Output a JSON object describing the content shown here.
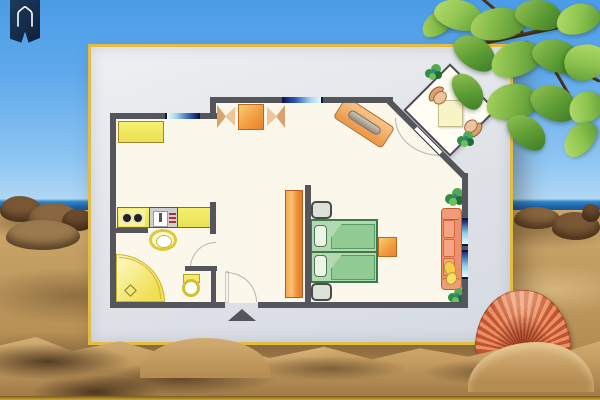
{
  "scene": {
    "type": "beach-themed apartment floor plan illustration",
    "background_elements": [
      "sky",
      "sea-horizon",
      "sandy-beach-dunes",
      "beach-rocks",
      "tree-branch-with-green-leaves",
      "scallop-seashell",
      "house-banner-badge"
    ],
    "badge": {
      "icon": "house-icon",
      "banner_color": "#16304f",
      "glyph_color": "#ffffff"
    },
    "palette": {
      "sky": "#58a8ea",
      "sea": "#1b5fa8",
      "sand": "#c49f64",
      "frame_border_gold": "#e2bd45",
      "mat_gray": "#e3e6ea",
      "wall_gray": "#55565c",
      "floor_cream": "#fbf7ea",
      "yellow_fixture": "#f2e968",
      "orange_furniture": "#f09a40",
      "sofa_coral": "#f0906a",
      "bed_green": "#aed8ae",
      "window_blue": "#122f7e",
      "plant_green": "#2f8f45",
      "shell_orange": "#d4653a",
      "leaf_green": "#6fae41"
    }
  },
  "floorplan": {
    "rooms": [
      {
        "name": "kitchen",
        "furniture": [
          "wall-cabinet",
          "kitchen-counter",
          "stove-two-burners",
          "kitchen-sink-unit",
          "wash-basin"
        ]
      },
      {
        "name": "bathroom",
        "furniture": [
          "corner-shower",
          "toilet",
          "door-swing"
        ]
      },
      {
        "name": "entry-hall",
        "furniture": [
          "entrance-door-swing",
          "entrance-triangle-marker",
          "wardrobe"
        ]
      },
      {
        "name": "living-bedroom",
        "furniture": [
          "double-bed",
          "nightstand-top",
          "nightstand-bottom",
          "side-table",
          "sofa-with-pillows",
          "dining-table",
          "dining-chair-left",
          "dining-chair-right",
          "angled-sideboard",
          "plant",
          "plant",
          "terrace-door-swing"
        ]
      },
      {
        "name": "diagonal-terrace",
        "furniture": [
          "terrace-table",
          "wicker-chair",
          "wicker-chair",
          "plant",
          "plant"
        ]
      }
    ],
    "window_count": 4,
    "door_count": 4,
    "entrance_marker": "dark-triangle-arrow"
  }
}
